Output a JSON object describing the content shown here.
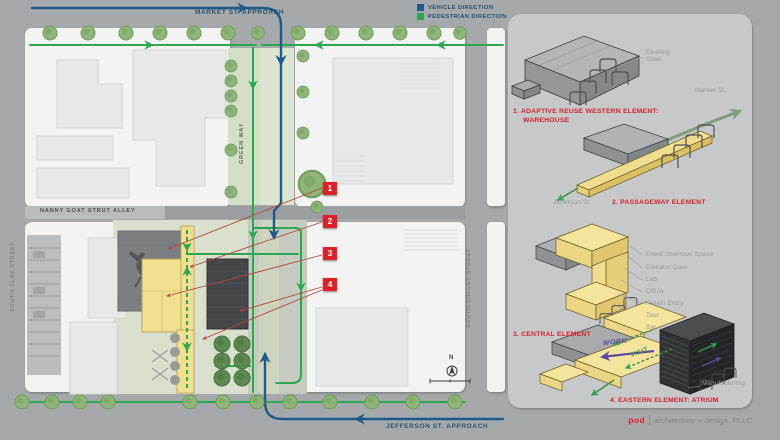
{
  "legend": {
    "items": [
      {
        "label": "VEHICLE DIRECTION",
        "color": "#1e5a8a"
      },
      {
        "label": "PEDESTRIAN DIRECTION",
        "color": "#2ca84e"
      }
    ]
  },
  "site_plan": {
    "streets": {
      "market_approach": "MARKET ST. APPROACH",
      "jefferson_approach": "JEFFERSON ST. APPROACH",
      "green_way": "GREEN WAY",
      "nanny_goat_alley": "NANNY GOAT STRUT ALLEY",
      "south_clay": "SOUTH CLAY STREET",
      "south_shelby": "SOUTH SHELBY STREET"
    },
    "north_label": "N",
    "markers": [
      {
        "number": "1"
      },
      {
        "number": "2"
      },
      {
        "number": "3"
      },
      {
        "number": "4"
      }
    ]
  },
  "panel": {
    "diagrams": [
      {
        "title": "1. ADAPTIVE REUSE WESTERN ELEMENT:",
        "subtitle": "WAREHOUSE",
        "annotation": "Existing Steel",
        "street": "Market St."
      },
      {
        "title": "2. PASSAGEWAY ELEMENT",
        "street": "Jefferson St."
      },
      {
        "title": "3. CENTRAL ELEMENT",
        "annotations": [
          "Event Overlook Space",
          "Elevator Core",
          "Lab",
          "Office",
          "Retail/ Entry",
          "Tour",
          "Bar"
        ]
      },
      {
        "title": "4. EASTERN ELEMENT:  ATRIUM",
        "annotation": "Manufacturing",
        "flow_labels": {
          "work": "WORK",
          "visit": "VISIT"
        }
      }
    ],
    "credit": {
      "brand": "pod",
      "firm": "architecture + design, PLLC"
    }
  },
  "colors": {
    "background": "#a6a9ab",
    "panel": "#c6c8c9",
    "vehicle_blue": "#1e5a8a",
    "pedestrian_green": "#2ca84e",
    "accent_red": "#e01f26",
    "element_yellow": "#f2e091",
    "dark_building": "#43474a",
    "flow_purple": "#5b4ba0"
  }
}
